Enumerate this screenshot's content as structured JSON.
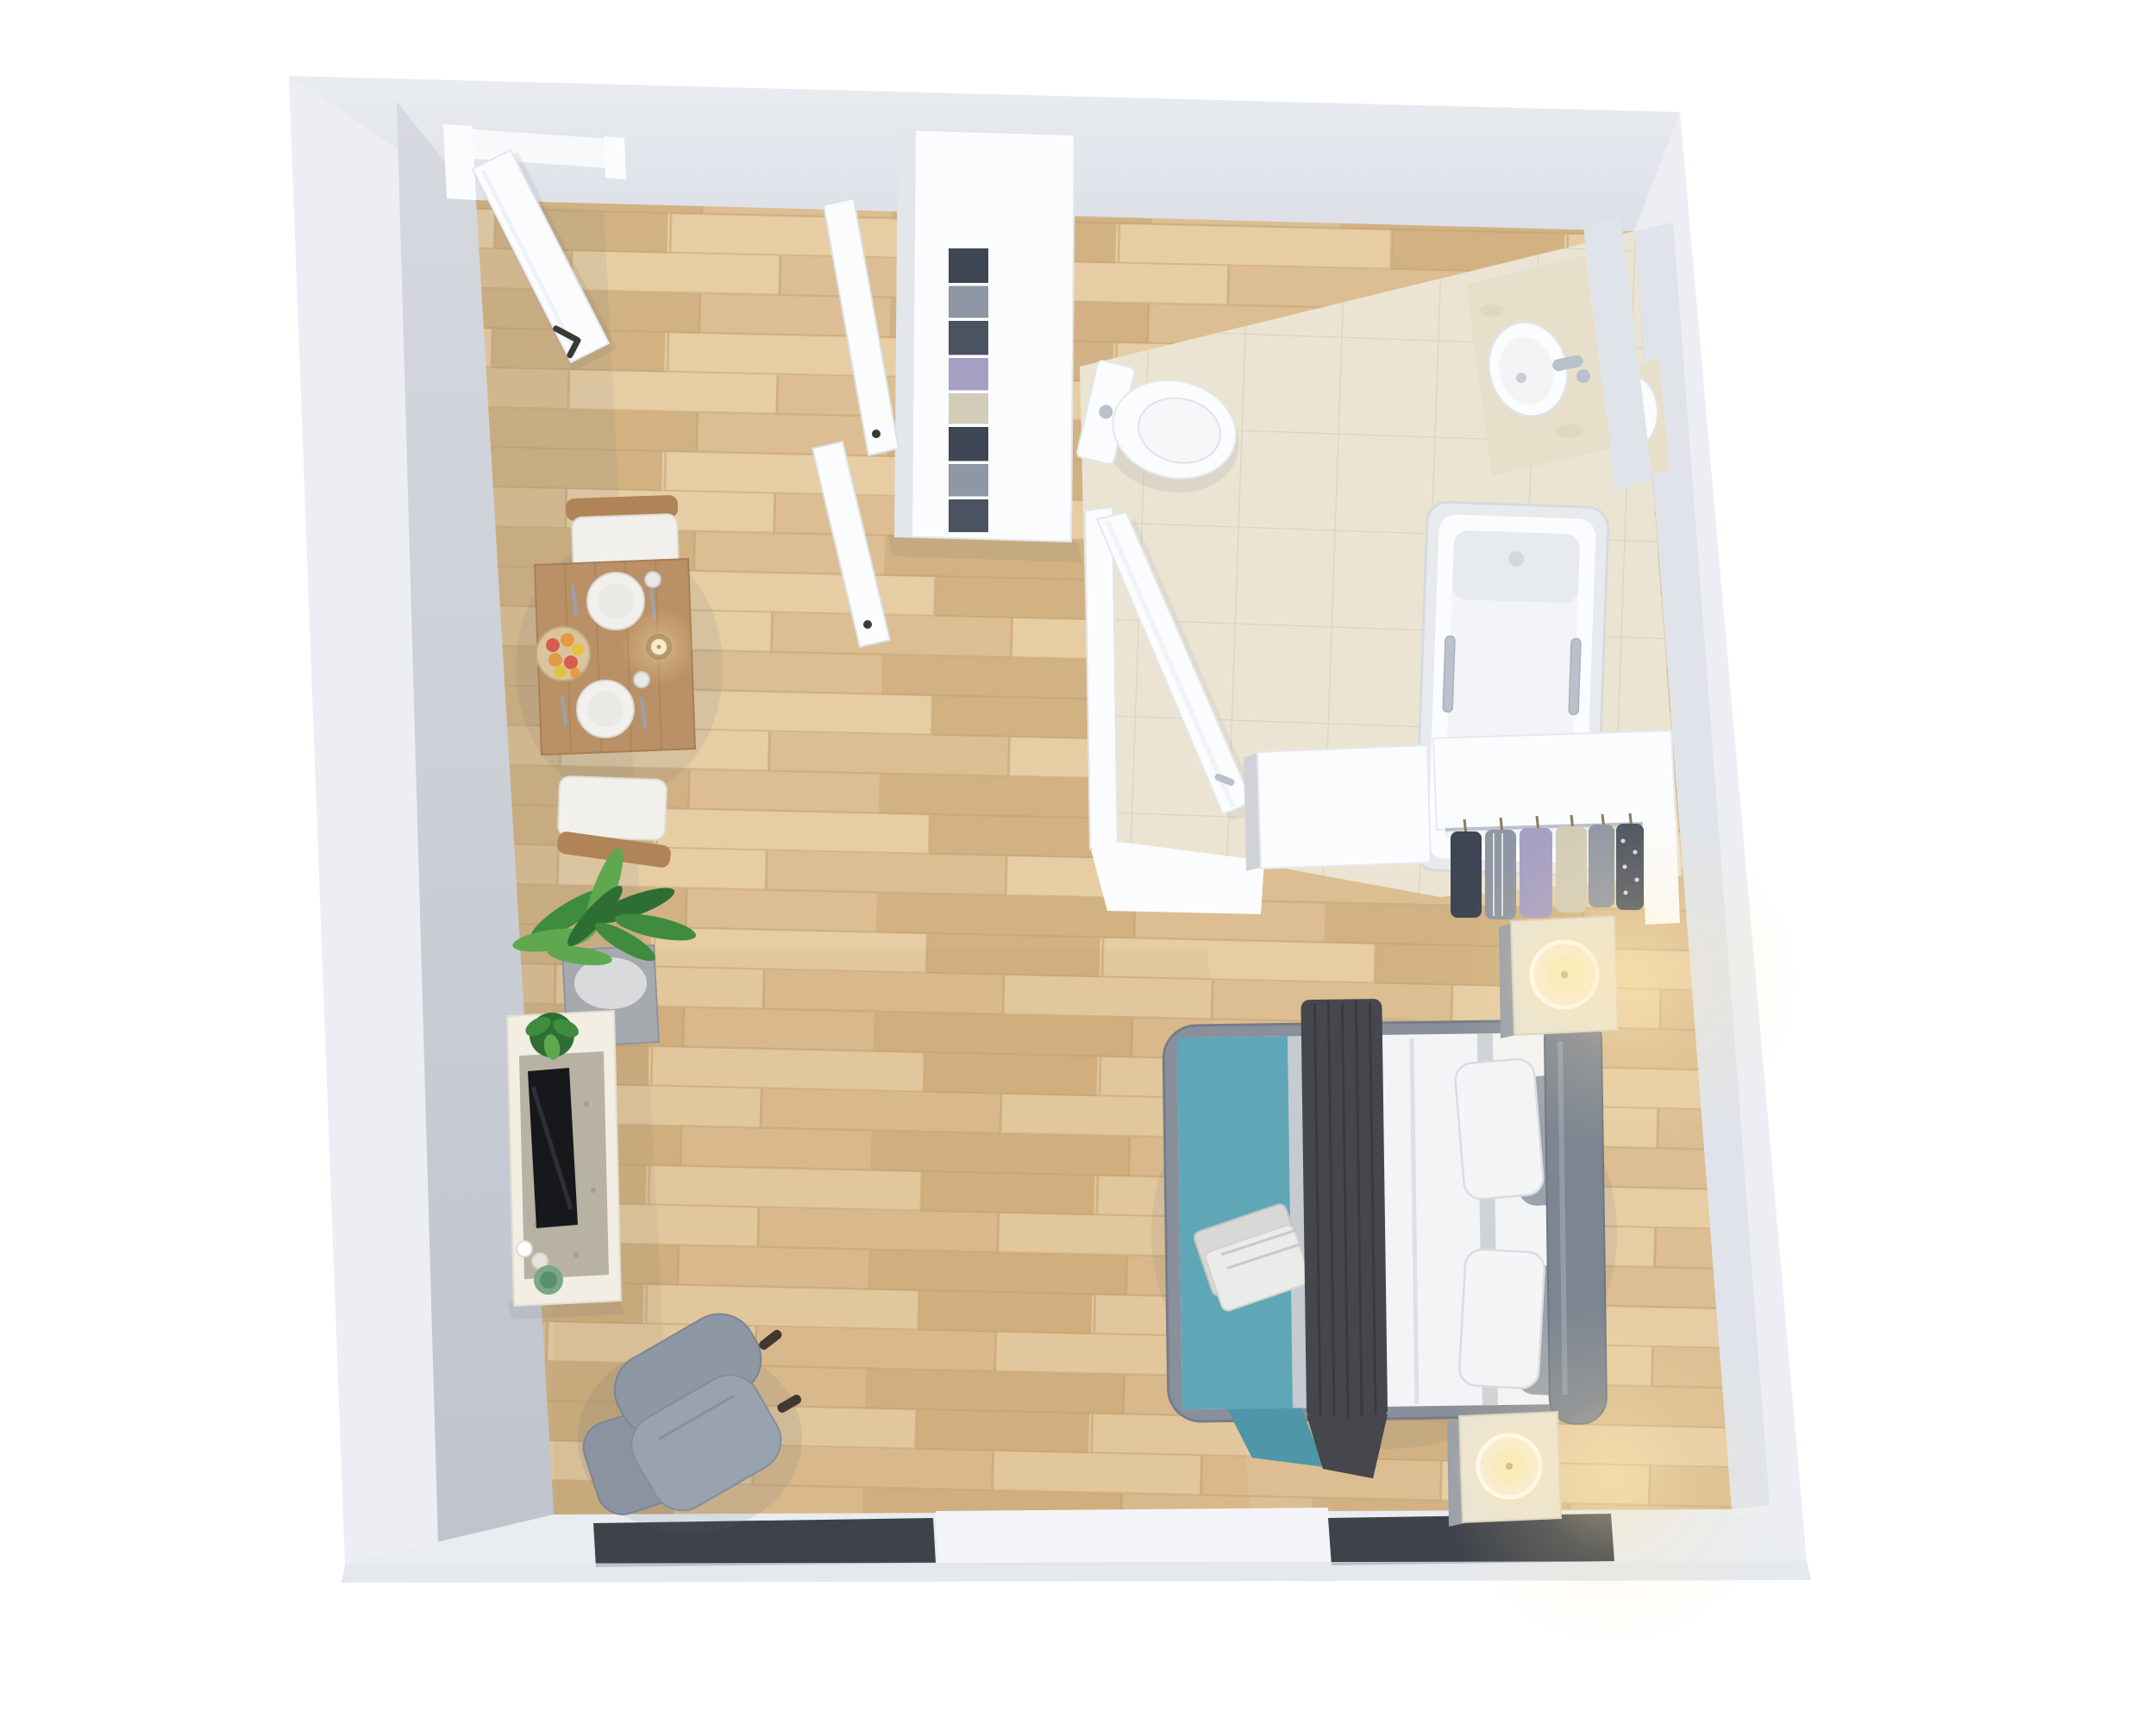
{
  "scene": {
    "title": "Top-down 3D floor plan render of a studio apartment",
    "view": "bird's-eye 3D render",
    "background": "#ffffff",
    "rooms": [
      {
        "name": "main-room",
        "floor": "light oak wood planks",
        "contains": "entry, dining, living, sleeping areas"
      },
      {
        "name": "bathroom",
        "floor": "beige ceramic tile",
        "position": "top-right"
      },
      {
        "name": "walk-in-closet",
        "floor": "wood",
        "position": "right-center"
      }
    ]
  },
  "palette": {
    "page-bg": "#ffffff",
    "wall-outer": "#eceef3",
    "wall-band": "#e9ecf1",
    "wall-face": "#c9cdd6",
    "wall-face-dark": "#bfc4cd",
    "wall-inner-strip": "#e0e4ea",
    "white-furniture": "#fbfcfd",
    "white-shadow": "#e3e6eb",
    "floor-wood-1": "#e6cda4",
    "floor-wood-2": "#dcbe92",
    "floor-wood-3": "#d2b283",
    "floor-wood-gap": "#c3a374",
    "tile-base": "#ebe4d3",
    "tile-grout": "#dcd4bf",
    "marble": "#e7dfca",
    "chrome": "#b9c1cb",
    "bed-teal": "#5fa7b6",
    "bed-teal-deep": "#4f97a8",
    "sheet-gray": "#c5cbd1",
    "throw-dark": "#46464d",
    "duvet-white": "#f3f4f6",
    "pillow-gray": "#9ba2ad",
    "bed-frame": "#8a909b",
    "headboard": "#7d8591",
    "nightstand-cream": "#eae4d3",
    "nightstand-side": "#9aa0a8",
    "candle-glow": "#ffe9b0",
    "candle-cream": "#f6efdc",
    "wick": "#3a3a33",
    "window-dark": "#3e434a",
    "plant-green": "#3f8b3f",
    "plant-green-light": "#5fa850",
    "plant-dark": "#2e6e33",
    "planter-gray": "#a6aaaf",
    "console-cream": "#f2eee4",
    "console-recess": "#b7b2a4",
    "tv-black": "#17181c",
    "table-wood": "#ba9166",
    "table-wood-dark": "#a27c50",
    "chair-white": "#f1f0ec",
    "wood-frame": "#b08457",
    "armchair-gray": "#8e97a4",
    "armchair-light": "#99a2af",
    "ottoman-gray": "#8a939f",
    "clothes-navy": "#3e4654",
    "clothes-gray": "#8f96a4",
    "clothes-lavender": "#a59fc4",
    "clothes-cream": "#d2ccb8",
    "clothes-dark": "#4c5360",
    "fruit-red": "#d85c4a",
    "fruit-orange": "#e59a46",
    "fruit-yellow": "#e2c23f",
    "green-bowl": "#7aa887",
    "soft-shadow": "#5a6478"
  },
  "furniture": {
    "entry": [
      "open entry door with dark handle"
    ],
    "dining": {
      "table": "rectangular wood dining table",
      "chairs": 2,
      "tabletop_items": [
        "2 white place settings",
        "wood plate with fruit",
        "amber candle",
        "cutlery",
        "2 glasses"
      ]
    },
    "living": [
      "tv sideboard",
      "flat tv lying on console",
      "tall potted plant in gray planter",
      "small green plant",
      "green bowl",
      "gray recliner armchair",
      "gray ottoman"
    ],
    "sleeping": [
      "double bed with gray upholstered frame",
      "teal blanket",
      "dark gray throw",
      "white duvet",
      "2 white pillows",
      "2 gray pillows",
      "folded gray towels",
      "2 cream nightstands",
      "2 lit candles"
    ],
    "bathroom": [
      "wall-hung toilet with cistern panel",
      "marble vanity with twin sinks and chrome faucets",
      "bathtub with chrome handles",
      "open white bathroom door"
    ],
    "closet": [
      "tall white wardrobe with folded clothes",
      "2 open wardrobe doors",
      "open hanging rail with 6 garments",
      "white counter cabinets"
    ],
    "windows": 2,
    "candles_lit": 3
  }
}
